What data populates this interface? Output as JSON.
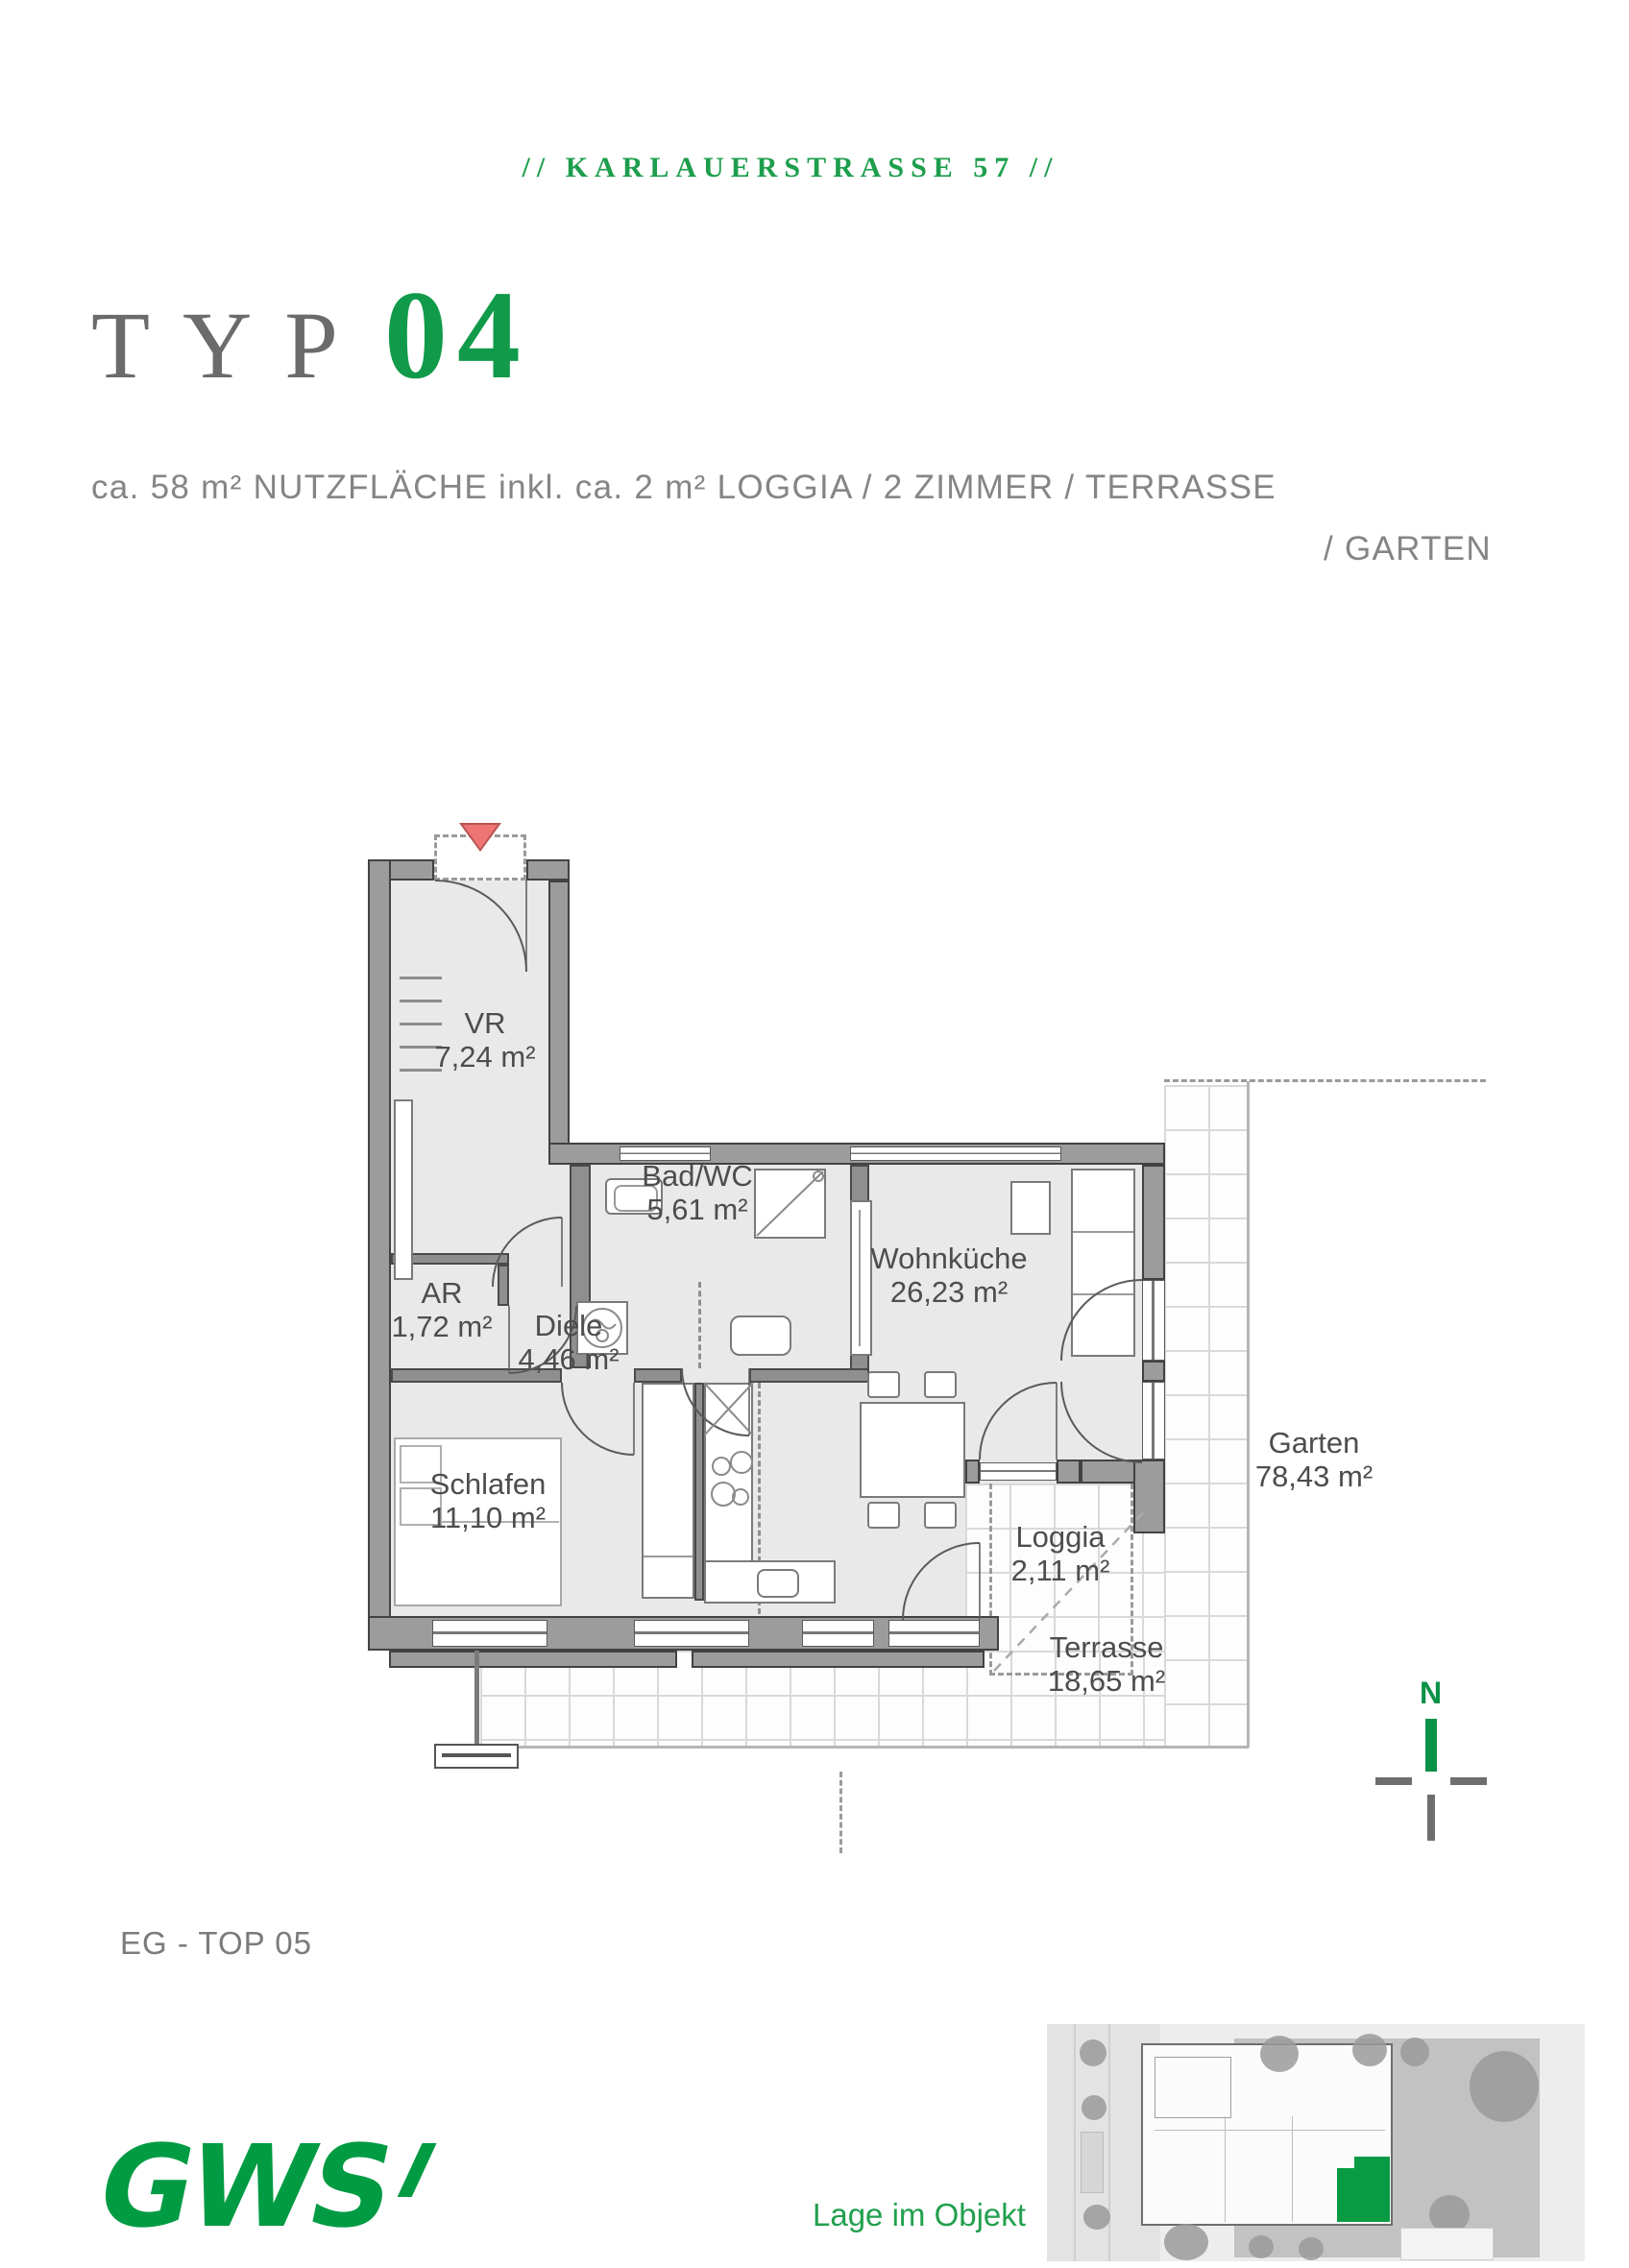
{
  "header": {
    "street": "//  KARLAUERSTRASSE 57  //"
  },
  "title": {
    "prefix": "TYP",
    "number": "04"
  },
  "subtitle": {
    "line1": "ca. 58 m² NUTZFLÄCHE inkl. ca. 2 m² LOGGIA  /  2 ZIMMER  /  TERRASSE",
    "line2": "/  GARTEN"
  },
  "rooms": [
    {
      "name": "VR",
      "area": "7,24 m²"
    },
    {
      "name": "Bad/WC",
      "area": "5,61 m²"
    },
    {
      "name": "AR",
      "area": "1,72 m²"
    },
    {
      "name": "Diele",
      "area": "4,46 m²"
    },
    {
      "name": "Wohnküche",
      "area": "26,23 m²"
    },
    {
      "name": "Schlafen",
      "area": "11,10 m²"
    },
    {
      "name": "Loggia",
      "area": "2,11 m²"
    },
    {
      "name": "Terrasse",
      "area": "18,65 m²"
    },
    {
      "name": "Garten",
      "area": "78,43 m²"
    }
  ],
  "annotations": {
    "unit": "EG - TOP 05",
    "compass_north": "N",
    "site_caption": "Lage im Objekt"
  },
  "logo": {
    "text": "GWS"
  },
  "colors": {
    "accent_green": "#109a49",
    "logo_green": "#009b43",
    "wall_gray": "#9c9c9c",
    "floor_gray": "#e9e9e9",
    "entrance_red": "#ef7474"
  }
}
